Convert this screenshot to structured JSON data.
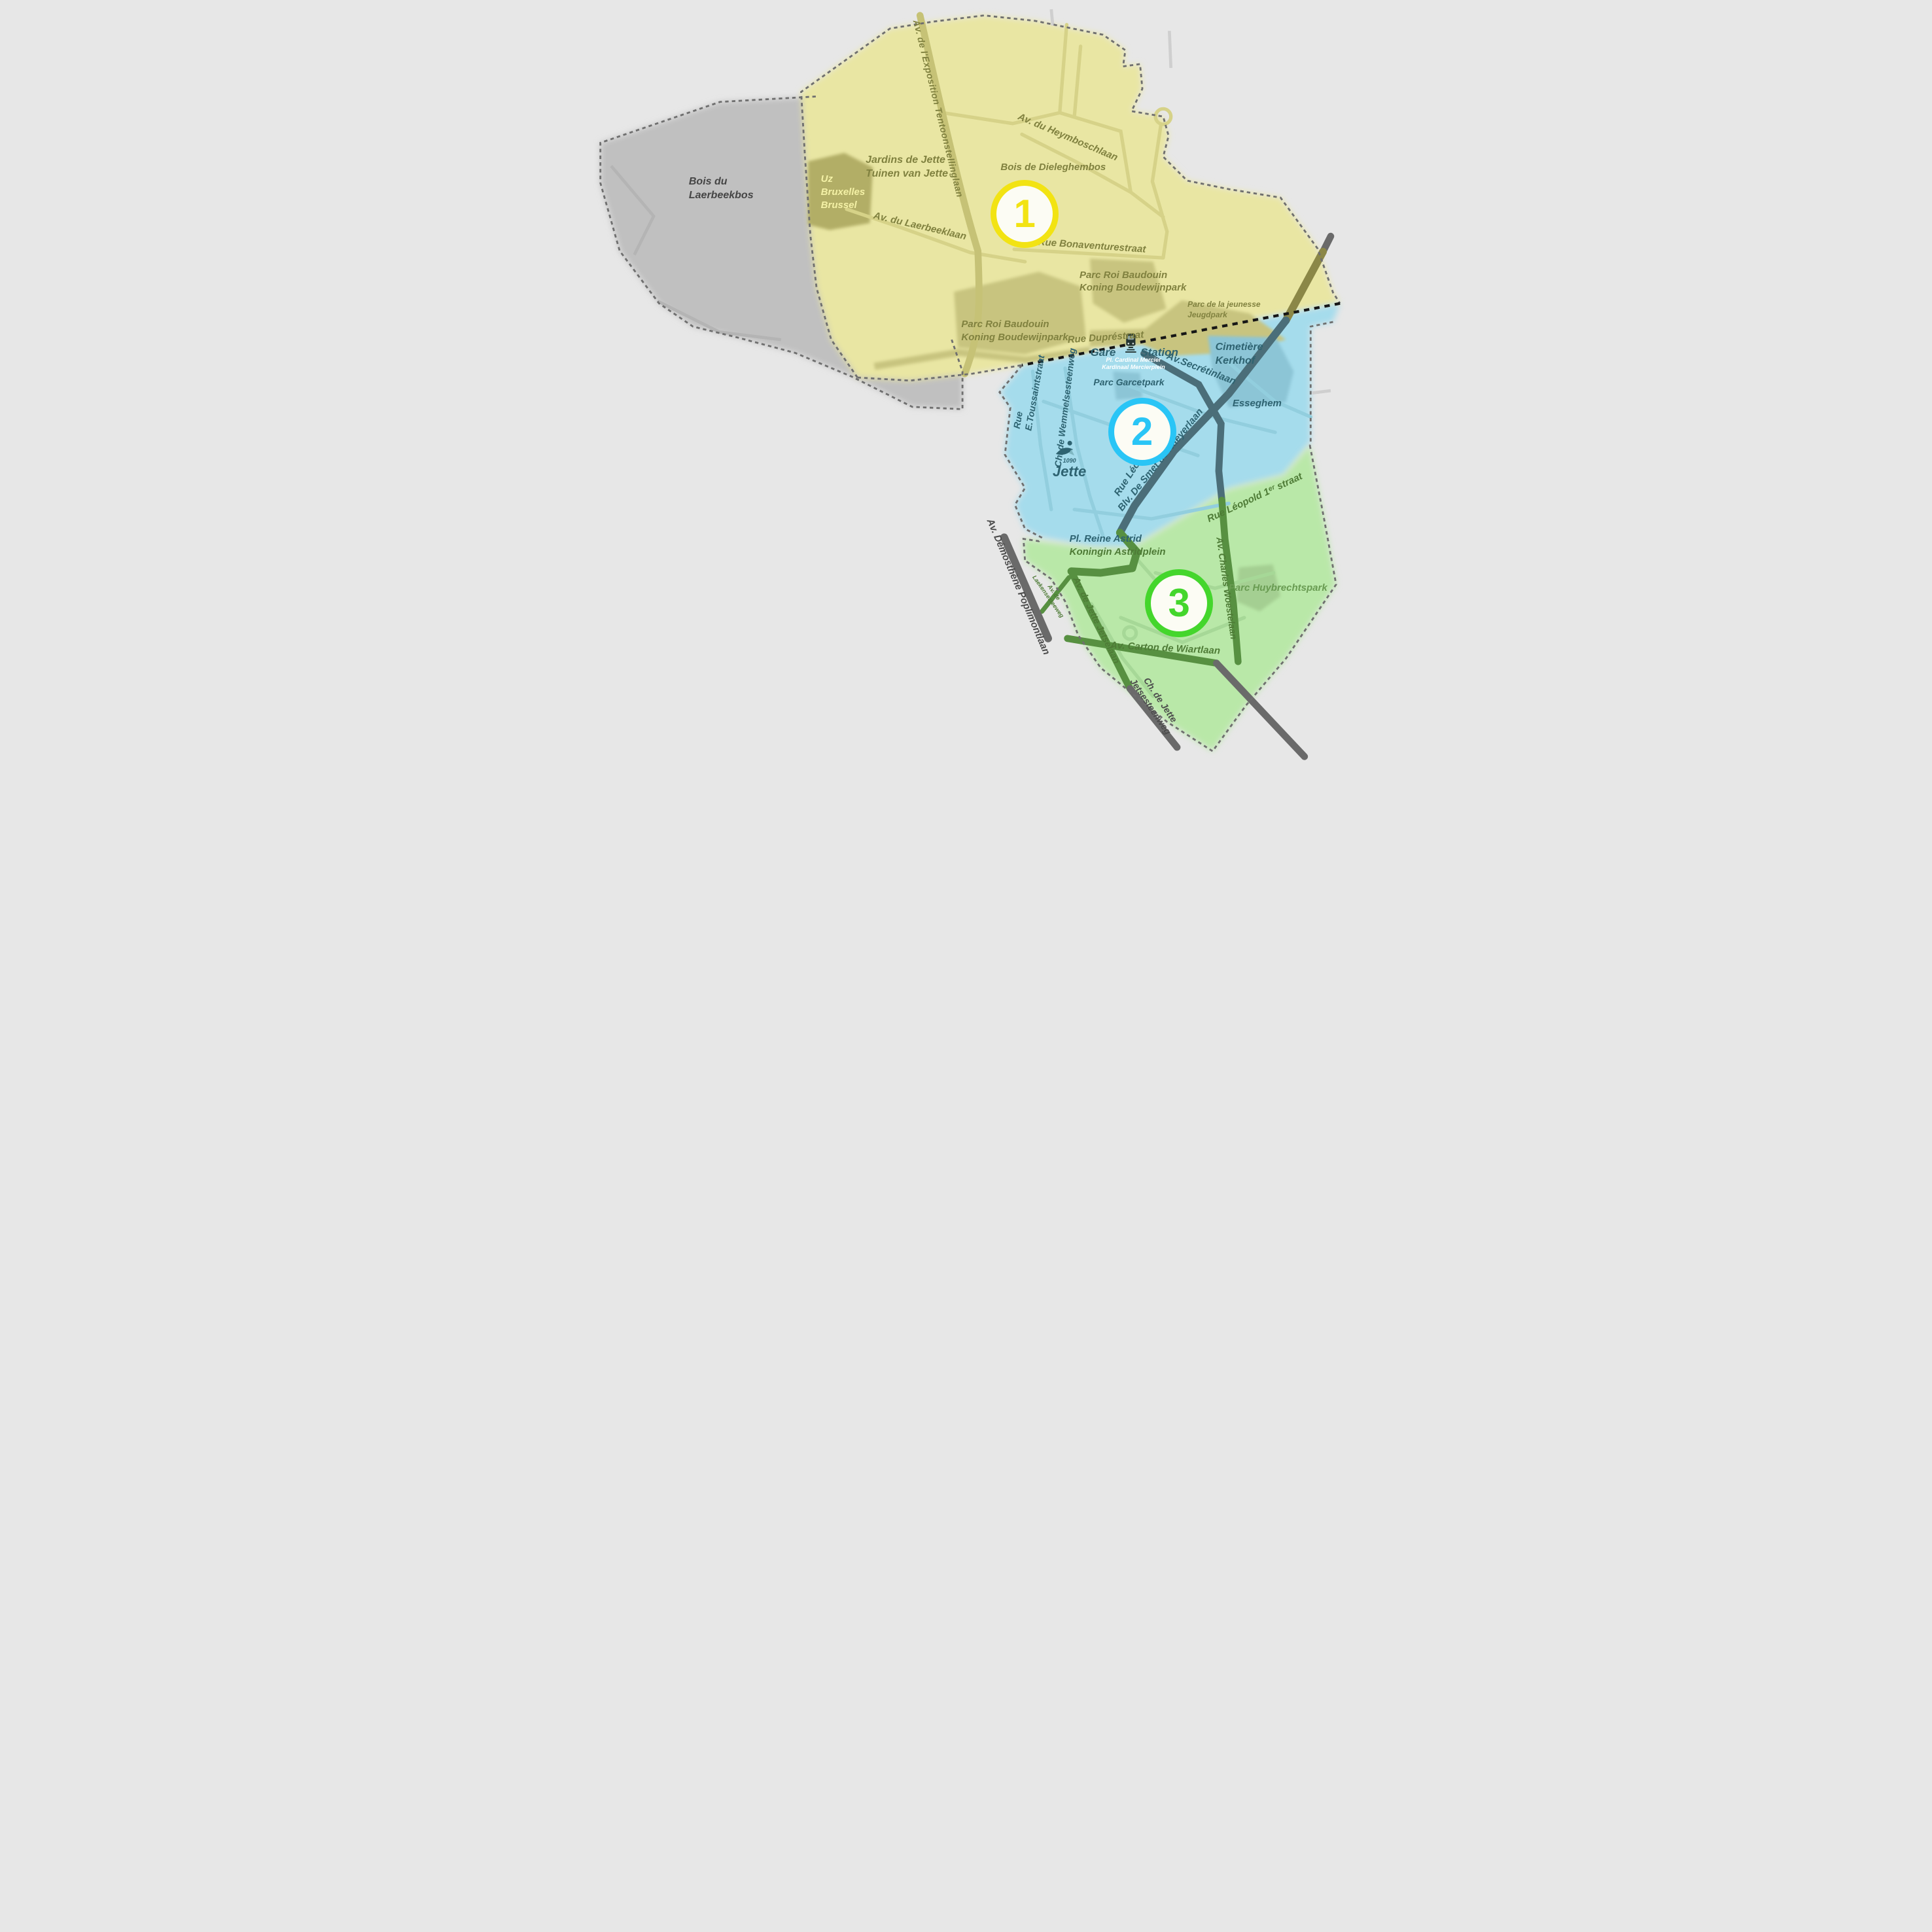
{
  "map": {
    "title_context": "Jette district sector map",
    "zones": [
      {
        "number": "1",
        "marker_color": "#f2e313",
        "fill_color": "#e9e6a3"
      },
      {
        "number": "2",
        "marker_color": "#29c5f6",
        "fill_color": "#a5dcec"
      },
      {
        "number": "3",
        "marker_color": "#44d62c",
        "fill_color": "#b9e8a8"
      }
    ],
    "colors": {
      "background": "#e7e7e7",
      "outside_area": "#c0c0c0",
      "uz_area": "#b2ae66",
      "yellow_park": "#c8c47f",
      "blue_park": "#8cc5d6",
      "green_park": "#a4cf92",
      "dark_road_blue_zone": "#4b6e79",
      "dark_road_green_zone": "#579041",
      "dark_road_outside": "#6a6a6a",
      "boundary_dash": "#6f6f6f",
      "rail_dots": "#161616"
    },
    "labels": {
      "laerbeekbos": [
        "Bois du",
        "Laerbeekbos"
      ],
      "uz": [
        "Uz",
        "Bruxelles",
        "Brussel"
      ],
      "jardins": [
        "Jardins de Jette",
        "Tuinen van Jette"
      ],
      "exposition": "Av. de l'Exposition Tentoonstellinglaan",
      "heymbosch": "Av. du Heymboschlaan",
      "dieleghembos": "Bois de Dieleghembos",
      "laerbeeklaan": "Av. du Laerbeeklaan",
      "bonaventure": "Rue Bonaventurestraat",
      "prb_right": [
        "Parc Roi Baudouin",
        "Koning Boudewijnpark"
      ],
      "jeugdpark": [
        "Parc de la jeunesse",
        "Jeugdpark"
      ],
      "prb_left": [
        "Parc Roi Baudouin",
        "Koning Boudewijnpark"
      ],
      "dupre": "Rue Dupréstraat",
      "gare": "Gare",
      "station": "Station",
      "mercier": [
        "Pl. Cardinal Mercier",
        "Kardinaal Mercierplein"
      ],
      "cimetiere": [
        "Cimetière",
        "Kerkhof"
      ],
      "secretin": "Av.Secrétinlaan",
      "garcet": "Parc Garcetpark",
      "esseghem": "Esseghem",
      "toussaint": [
        "Rue",
        "E.Toussaintstraat"
      ],
      "wemmel": "Ch. de Wemmelsesteenweg",
      "jette_logo": {
        "code": "1090",
        "name": "Jette"
      },
      "rue_leo": "Rue Léo",
      "smet": "Blv. De Smet de Naeyerlaan",
      "leopold": "Rue Léopold 1ᵉʳ straat",
      "astrid": [
        "Pl. Reine Astrid",
        "Koningin Astridplein"
      ],
      "poplimont": "Av. Démosthène Poplimontlaan",
      "laeken": [
        "Av. de",
        "Laekensesteeweg"
      ],
      "jetselaan": "Av. de Jette Jetselaan",
      "woestelaan": "Av. Charles Woestelaan",
      "huybrechts": "Parc Huybrechtspark",
      "wiart": "Av. Carton de Wiartlaan",
      "chdejette": [
        "Ch. de Jette",
        "Jetsesteenweg"
      ]
    }
  }
}
